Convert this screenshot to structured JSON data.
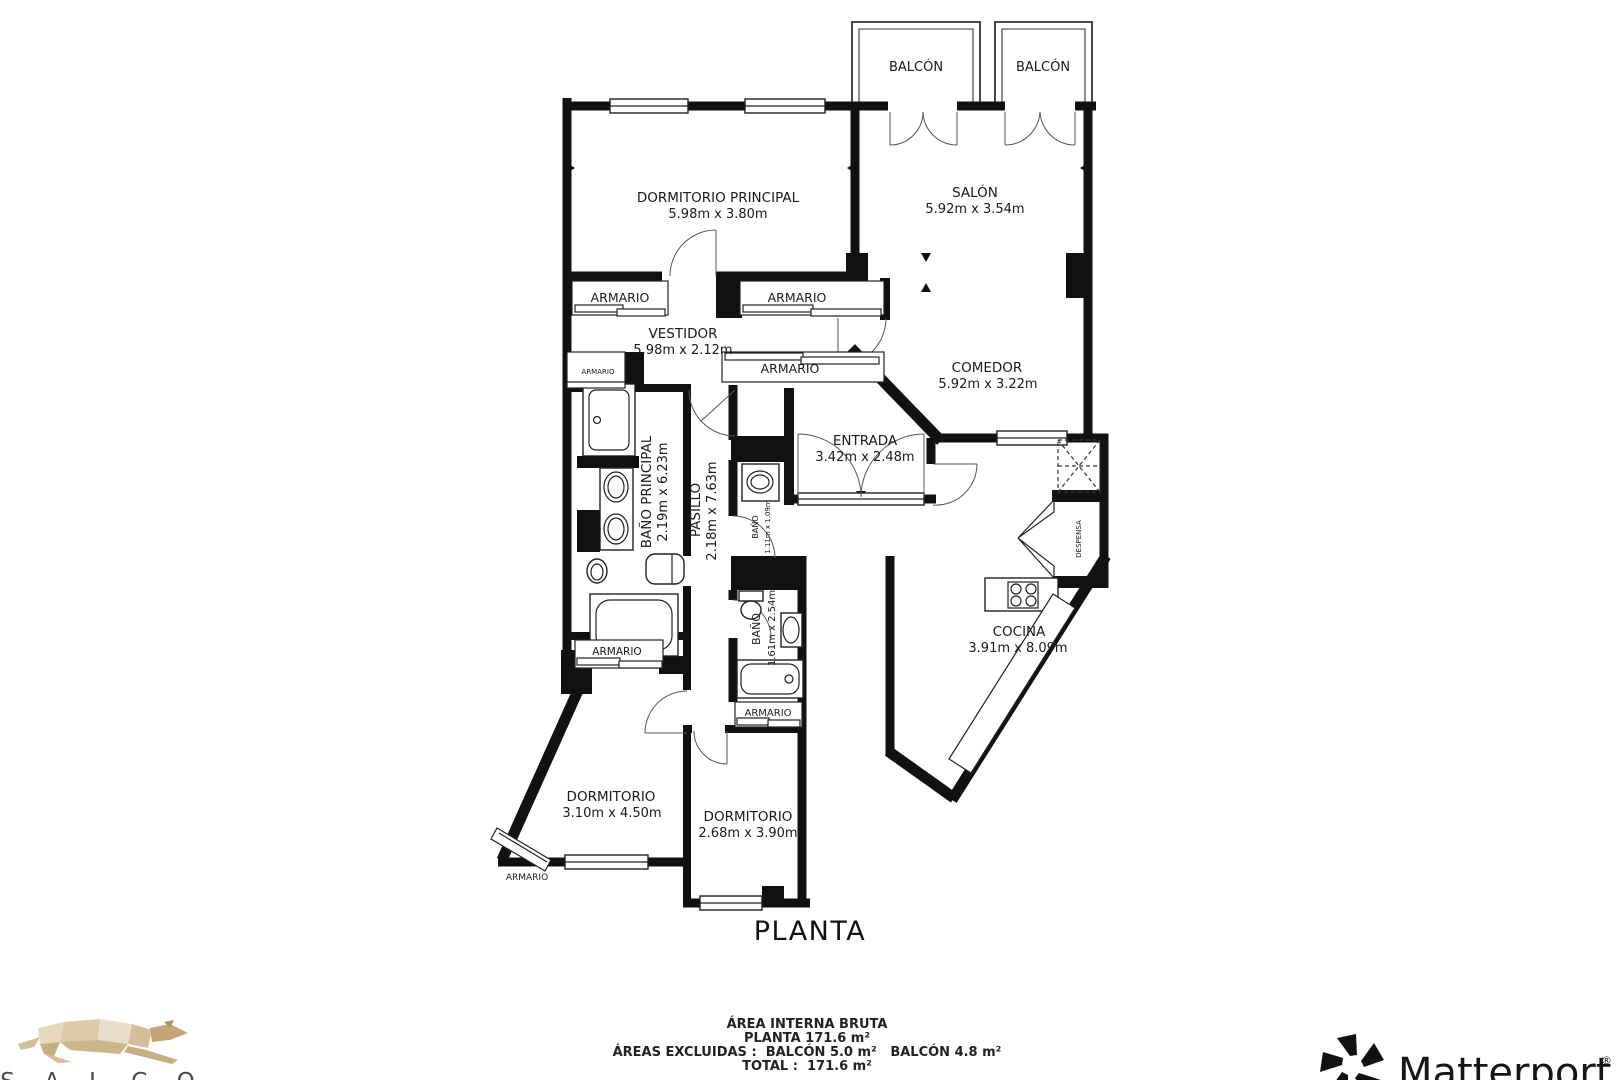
{
  "plan": {
    "title": "PLANTA",
    "closet_label": "ARMARIO",
    "balconies": {
      "left": "BALCÓN",
      "right": "BALCÓN"
    },
    "rooms": {
      "dormitorio_principal": {
        "name": "DORMITORIO PRINCIPAL",
        "dims": "5.98m x 3.80m"
      },
      "salon": {
        "name": "SALÓN",
        "dims": "5.92m x 3.54m"
      },
      "vestidor": {
        "name": "VESTIDOR",
        "dims": "5.98m x 2.12m"
      },
      "comedor": {
        "name": "COMEDOR",
        "dims": "5.92m x 3.22m"
      },
      "entrada": {
        "name": "ENTRADA",
        "dims": "3.42m x 2.48m"
      },
      "bano_principal": {
        "name": "BAÑO PRINCIPAL",
        "dims": "2.19m x 6.23m"
      },
      "pasillo": {
        "name": "PASILLO",
        "dims": "2.18m x 7.63m"
      },
      "bano_pequeno": {
        "name": "BAÑO",
        "dims": "1.11m x 1.09m"
      },
      "bano": {
        "name": "BAÑO",
        "dims": "1.61m x 2.54m"
      },
      "cocina": {
        "name": "COCINA",
        "dims": "3.91m x 8.09m"
      },
      "despensa": {
        "name": "DESPENSA"
      },
      "dormitorio_izquierdo": {
        "name": "DORMITORIO",
        "dims": "3.10m x 4.50m"
      },
      "dormitorio_central": {
        "name": "DORMITORIO",
        "dims": "2.68m x 3.90m"
      }
    }
  },
  "footer": {
    "line1": "ÁREA INTERNA BRUTA",
    "line2": "PLANTA 171.6 m²",
    "line3": "ÁREAS EXCLUIDAS :  BALCÓN 5.0 m²   BALCÓN 4.8 m²",
    "line4": "TOTAL :  171.6 m²"
  },
  "branding": {
    "agency_name": "S A L C O",
    "provider_name": "Matterport",
    "provider_mark": "®"
  },
  "colors": {
    "wall": "#111111",
    "background": "#ffffff",
    "logo_tan": "#d8c3a0",
    "logo_tan_light": "#ece1cd",
    "logo_tan_dark": "#c3a87e"
  }
}
